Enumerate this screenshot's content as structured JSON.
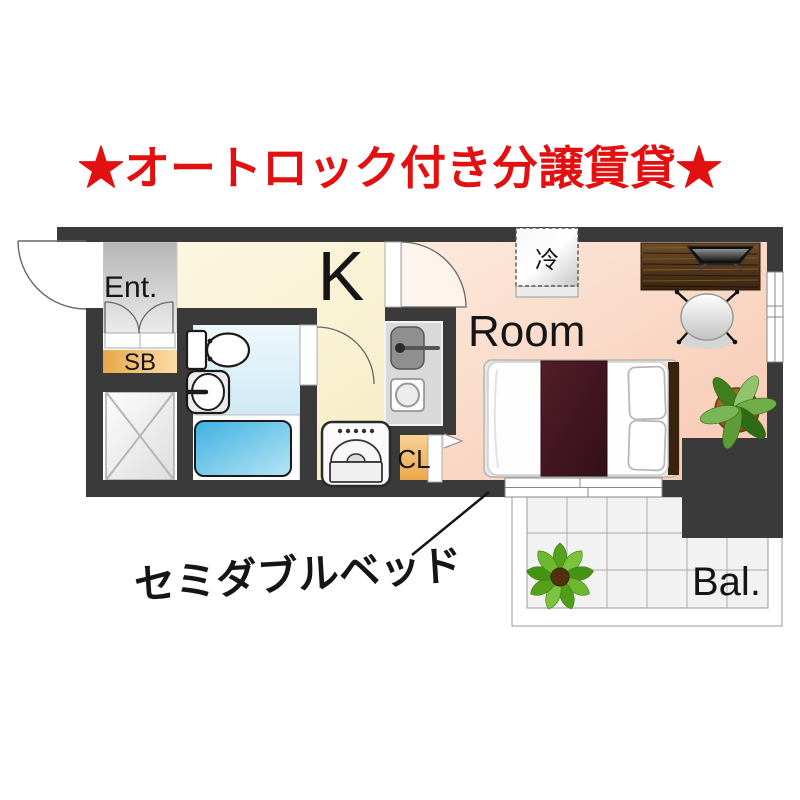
{
  "title": "★オートロック付き分譲賃貸★",
  "floorplan": {
    "labels": {
      "entrance": "Ent.",
      "shoe_box": "SB",
      "kitchen": "K",
      "room": "Room",
      "closet": "CL",
      "refrigerator": "冷",
      "balcony": "Bal."
    },
    "annotation": "セミダブルベッド"
  },
  "colors": {
    "title_red": "#e21010",
    "wall_dark": "#3a3a3a",
    "kitchen_floor": "#f8efcf",
    "room_floor": "#f9d8c6",
    "entrance_floor": "#c9c9c9",
    "bathroom_floor": "#dff0f8",
    "tub_blue": "#4fbbe4",
    "cabinet_orange": "#f3bc6d",
    "bed_blanket": "#461a24",
    "desk_wood": "#54351a",
    "balcony_tile": "#f2f2f2",
    "plant_green": "#6fae49"
  }
}
